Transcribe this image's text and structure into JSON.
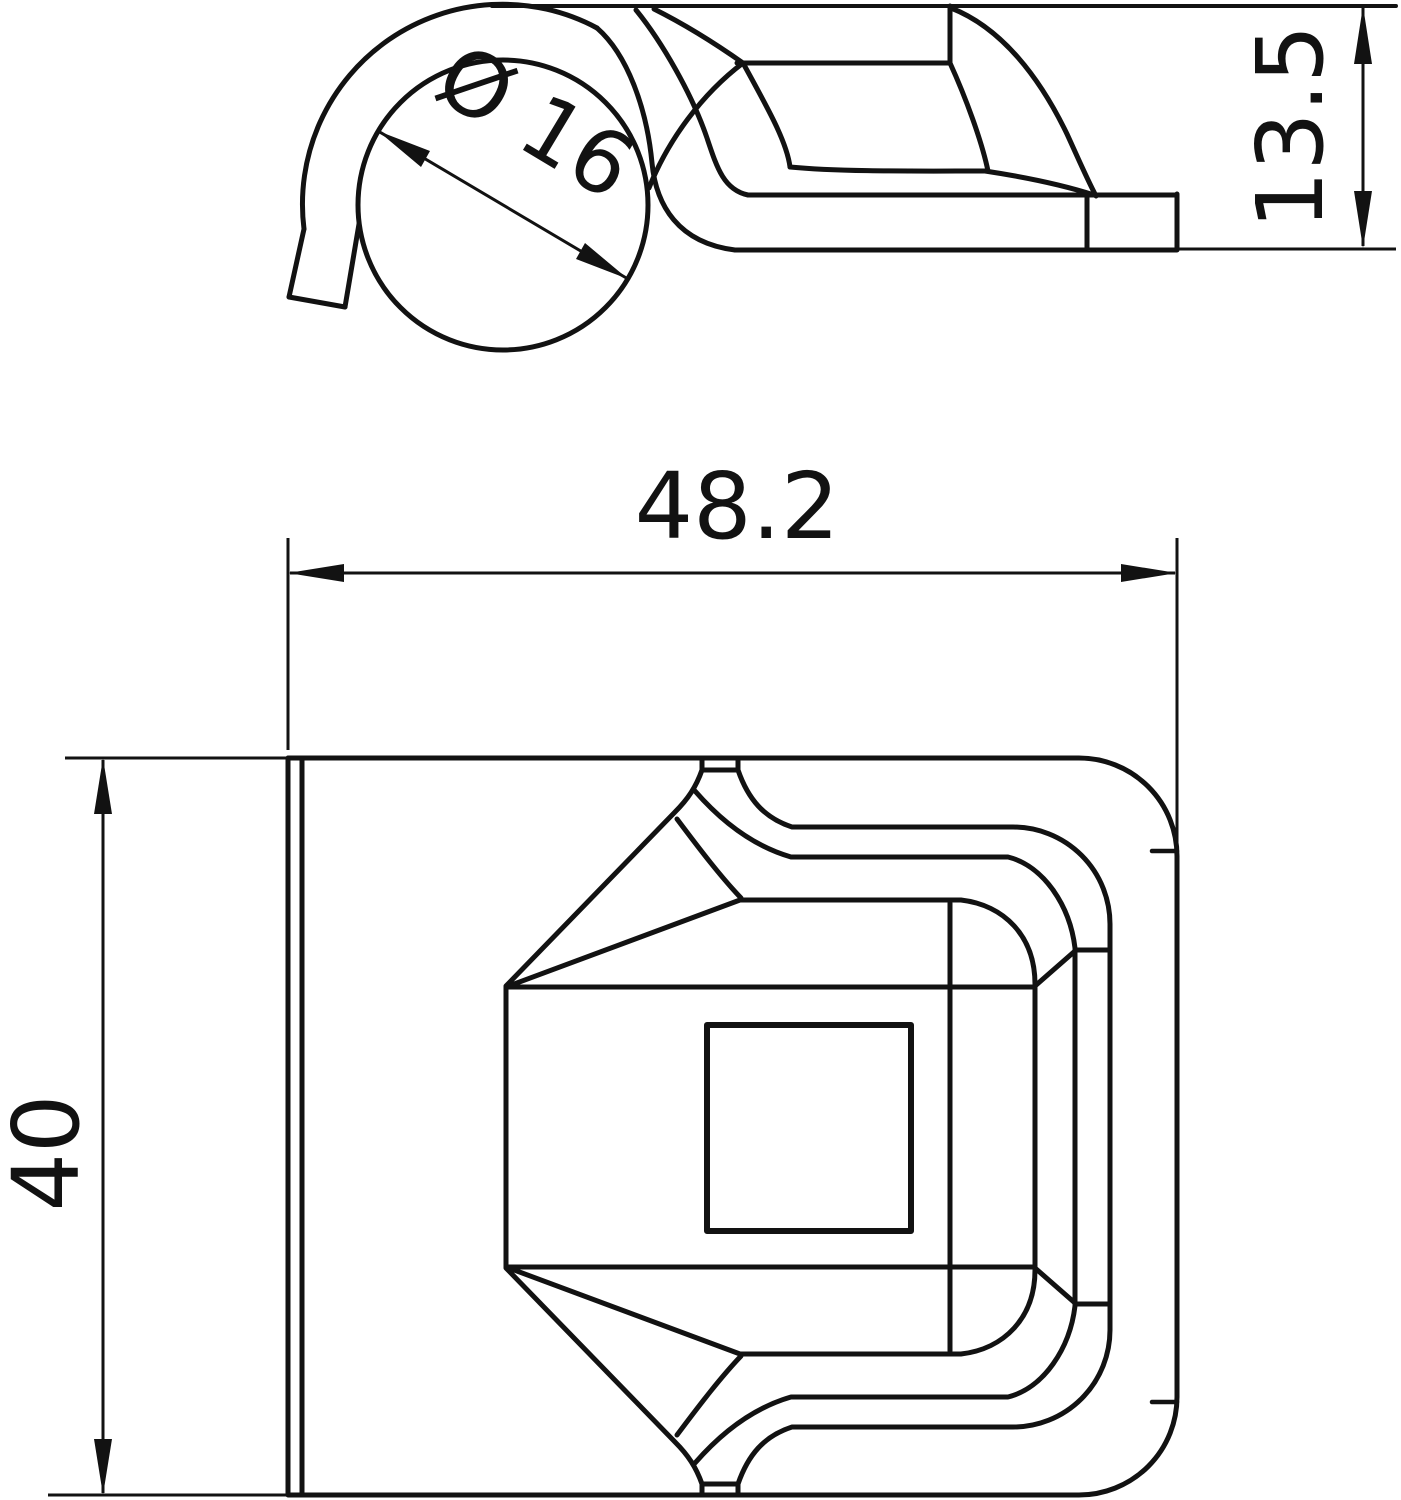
{
  "drawing": {
    "background_color": "#ffffff",
    "stroke_color": "#121212",
    "dimensions": {
      "diameter": {
        "label": "Ø 16",
        "value": 16
      },
      "height": {
        "label": "13.5",
        "value": 13.5
      },
      "width": {
        "label": "48.2",
        "value": 48.2
      },
      "length": {
        "label": "40",
        "value": 40
      }
    }
  }
}
